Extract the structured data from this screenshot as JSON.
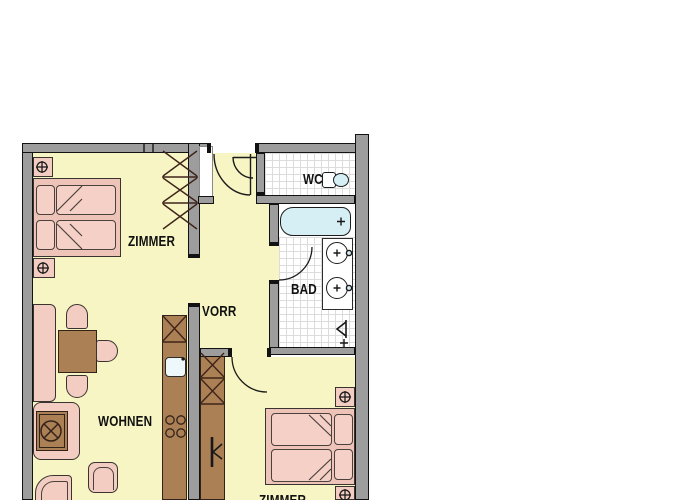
{
  "plan": {
    "type": "apartment-floor-plan",
    "rooms": [
      {
        "id": "zimmer-top",
        "label": "ZIMMER"
      },
      {
        "id": "vorraum",
        "label": "VORR"
      },
      {
        "id": "wohnen",
        "label": "WOHNEN"
      },
      {
        "id": "wc",
        "label": "WC"
      },
      {
        "id": "bad",
        "label": "BAD"
      },
      {
        "id": "zimmer-bottom",
        "label": "ZIMMER"
      }
    ],
    "fixtures": [
      "double-bed",
      "nightstand-lamp",
      "wardrobe",
      "dining-table",
      "chair",
      "bench",
      "corner-table-sofa",
      "armchair",
      "kitchenette",
      "kitchen-sink",
      "cooktop",
      "bathtub",
      "washbasin",
      "toilet",
      "shower",
      "door-swing",
      "entrance-door"
    ],
    "colors": {
      "floor": "#f6f5c3",
      "wall": "#9d9d9d",
      "outline": "#121212",
      "furniture_pink": "#f3cdc2",
      "wood_brown": "#ab8055",
      "water_blue": "#d6eff5",
      "tile_line": "#dcdcdc",
      "text": "#101010"
    }
  }
}
